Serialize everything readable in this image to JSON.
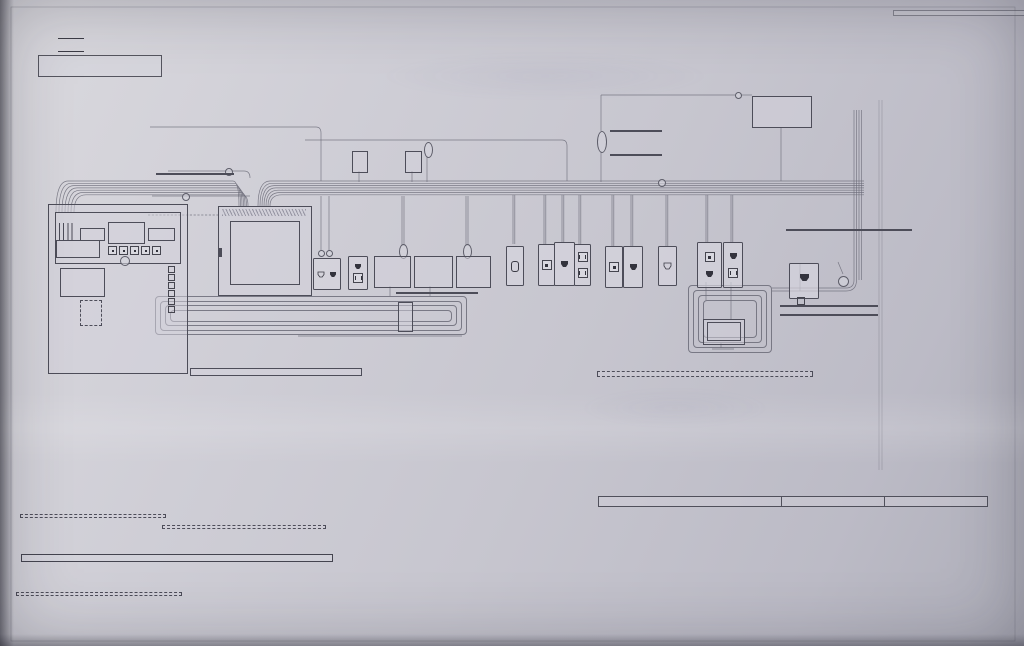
{
  "header": {
    "note_title": "※特記なき配管・配線は以下の通り",
    "spec_prefix": "※",
    "spec1": "CD16mm×1",
    "spec2": "S-5C-FB×1",
    "title": "アドバンスプレート"
  },
  "legend": {
    "items": [
      {
        "icon": "conduit-line",
        "label": "CD管・PF管"
      },
      {
        "icon": "coax-line",
        "label": "同軸ケーブル (S5C-FB)"
      },
      {
        "icon": "tel-jack",
        "label": "TELモジュラー"
      },
      {
        "icon": "lan-jack",
        "label": "LANモジュラー (1000BASE-T CAT-6)"
      },
      {
        "icon": "tv-terminal",
        "label": "TV端子"
      },
      {
        "icon": "outlet-100v",
        "label": "100Vコンセント"
      },
      {
        "icon": "locking-outlet",
        "label": "抜け止めコンセント"
      },
      {
        "icon": "power-earth",
        "label": "100V電源&アース付"
      },
      {
        "icon": "flush-box",
        "label": "埋込ボックス付"
      }
    ]
  },
  "box_detail": {
    "heading": "(BOX展開図)",
    "spare": "予備",
    "splitter": "分波器",
    "amplifier": "増幅器\n(ブースター)",
    "distributor": "分配器",
    "tel_terminal": "電話端子台\n(支給品接続)",
    "supplied": "(支給品接続)",
    "hub": "スイッチング\nHUB\n(実装手配)",
    "trunks": [
      "リモコン幹線",
      "HEMS幹線",
      "ホームサーバー",
      "エネファーム用"
    ],
    "lan_patch": "LANパッチ\nエネファーム用",
    "router": "ルーター\nお客様ご用意",
    "hub_space": "HUBスペース",
    "lan_edge": "LAN\n先端加工",
    "note": "※HUBはお客様にてご用意下さい。\n実装COM用意の場合は別途となります。"
  },
  "diagram": {
    "catv": "ケーブルTV\n引込口",
    "spare_wire": "予備配線",
    "kuhaikan": "空配管",
    "alsok": "ALSOK工事",
    "alsok_main": "ALSOK主装置へ",
    "tel_in": "TEL\n引込口",
    "one_line": "1回線",
    "fiber1": "光ファイバー用空配管\n(ここは22mm)",
    "fiber2": "光ファイバー用空配管\n[ここは22mm]",
    "tel_lan": "TEL×2+LAN×1",
    "antenna": "アンテナ用予備配線 (外壁)",
    "antenna_sub": "※支線取付金具もご用意下さい",
    "bs": "BS用予備配線 (外壁)",
    "jb": "J.B\n(電気工事)",
    "gas_meter": "ガスメーター付近\n(将来用)",
    "water_meter": "水道メーター付近\n(将来用)",
    "info_panel": "軽量型情報盤 (電気工事)",
    "info_panel_sub": "(上端FL+1600\n標準設置高さ\n2F23納入)",
    "panel_note": "この情報盤は有線の配線器具を\n収納する部材となっており\n無線の配線器具(AiSEGや無線ルーター)は\n収納しないで下さい。\n盤内に無線器具を配置すると\n通信できない場合がありますので\nご注意願います。",
    "jumper": "ジャンパー線\n(実装手配)",
    "east_shelf": "東 棚上\n(FL+2100)\n※ONUモデム\n設置位置",
    "south_shelf": "南 棚上\n(FL+2100)",
    "ct1": "CT延長ケーブル\nMKN74503×4 (実装送品)\n[22mm配管 電気工事]",
    "ct2": "CT延長ケーブル\nMKN74513×4 (実装送品)\n[22mm配管 電気工事]",
    "board1": "分電盤①\n(電気工事)\nCTセンサー\n(5回路取付)",
    "board2": "分電盤②\n(スマートコスモ)\n(電気工事)\n純正CTセンサー取付\n(実装手配)",
    "board3": "CTセンサー取付\n(実装手配)\n8分岐増設\n(電気工事)",
    "west": "西",
    "layout_note": "※設計時、配置&ベース確認願います",
    "pantry": "1F8パントリー",
    "aiseg": "AiSEG2本体\n(純正COM)\n支給品取付",
    "lan_patch2": "LANパッチ\n(実装手配)",
    "ded_cable": "専用ケーブル (電気工事)",
    "manual_note": "※施工に際しては、設計ご担当者様へ\nマニュアルの確認をお願い致します。",
    "tribrid": "トライブリッド\nパワコン\n(電気工事)",
    "north_cam": "北側カメラへ",
    "west_cam": "西側カメラへ",
    "lan2": "LAN×2\n(ここは22mm)",
    "to_panel": "軽量型情報盤へ",
    "remocon": "リモコン\n1F6\nキッチン",
    "room_living": "1F12\nリビング",
    "room_guest": "2F22\nゲストルーム",
    "room_den": "2F24\n書斎",
    "room_master": "2F20\n主寝室",
    "ant_splitter": "アンテナ分波器\n(実装手配)",
    "coax_patch": "同軸パッチケーブル\n(実装手配)",
    "home_server": "ホームサーバー",
    "monitor": "モニター",
    "lan_module": "露出LANモジュラー (LNJ-MT-6)",
    "lan_module_sub": "(実装手配)",
    "enefarm_connect": "接続はエネファーム工事にて",
    "jb_wp": "J.B (防水型)\n(1F外壁)\n(電気工事)",
    "enefarm": "エネファーム",
    "wp_lan1": "防水LANケーブル (実装手配)",
    "wp_lan2": "※取付・接続はエネファーム工事",
    "jb_note": "※LANモジュラー及び接続部を保護する為、\nJ.Bは防水型をご用意下さい。\n防水LANケーブルは先端保護をして、\nJ.Bに設置しておきます。",
    "server_note": "※ホームサーバーと、お客様のお持ちのテレビを接続する場合\n　HDMIケーブル及びアンテナケーブル等は、お客様にてご用意下さい。\n※ホームサーバーとモニター、及びインターホンモニター画像は\n　同一フロアにてご利用下さい。\n　環境によっては、無線の為映像が途切れる場合がございます。"
  },
  "notices": {
    "hems_box": "インターネット開通後、HEMSネット設定を致します。\n訪問設定日の登録は下記URLからお願いします。\nhttp://www.toeicom.co.jp\n接続方法に関しましては、別紙【HEMS補足資料】の\n接続図を参照下さい。",
    "remocon_box": "リモコン(蓄電池用)はルーターを介してAiSEG2と接続が必要です。\n未接続の場合、AiSEGで太陽光発電量・蓄電池残量の表示が\n出来なくなりますので必ずルーターのご用意をお願いします。",
    "main1": "軽量型情報盤内へ必要に応じてルーター・HUBのご用意をお願いします",
    "main2": "※インターネット事業者様にこちらの系統図をお渡し下さい",
    "phone_box": "電話回線の申込に際しては「電話引込工事」と依頼して下さい。",
    "bullet1": "●方角につきましては、平面図の上を北としております。",
    "bullet2": "●全ての100Vコンセントは図示しておりませんので、プレート形状は平面図を参照して下さい。"
  },
  "table": {
    "headers": [
      "実装工事",
      "ガス工事",
      "電気工事"
    ],
    "col1": [
      "ホームナビゲーションセット 材工",
      "アンテナ分波器・同軸パッチケーブル 材工",
      "AiSEG2本体 支給品取付",
      "CTセンサー 材工",
      "CT延長ケーブル接続 材工",
      "HEMSネット設定 材工",
      "LANパッチ 材工",
      "スイッチングHUB 材工",
      "TEL保安器〜軽量型情報盤間 接続",
      "軽量型情報盤〜端子間 接続",
      "電話端子台 支給品接続",
      "抜け止めコンセント 支給品接続",
      "TELモジュラー 材工",
      "LANモジュラー 材工",
      "防水LANケーブル 材のみ"
    ],
    "col2": [
      "増幅器・分波器・分配器 4K・8K対応 材工",
      "TV端子 4K・8K対応 材工",
      "ジャンパー線 材工",
      "アドバンスプレート 材工",
      "試験機による総合試験"
    ],
    "col3": [
      "エネファーム設置 材工",
      "防水LANケーブル 設置・接続"
    ],
    "col4": [
      "J.B 取付",
      "専用ケーブル 配線",
      "自立分電盤 取付",
      "住宅分電盤 取付",
      "軽量型情報盤 取付",
      "AC100V電源&アース線 BU-ET",
      "CD管・PF管(16・22mm) 配管",
      "同軸配線 (S5C-FB)",
      "裏BOX 取付",
      "ボード切り欠き",
      "ブースター等 電源 BU-ET",
      "AC100Vコンセント"
    ]
  }
}
